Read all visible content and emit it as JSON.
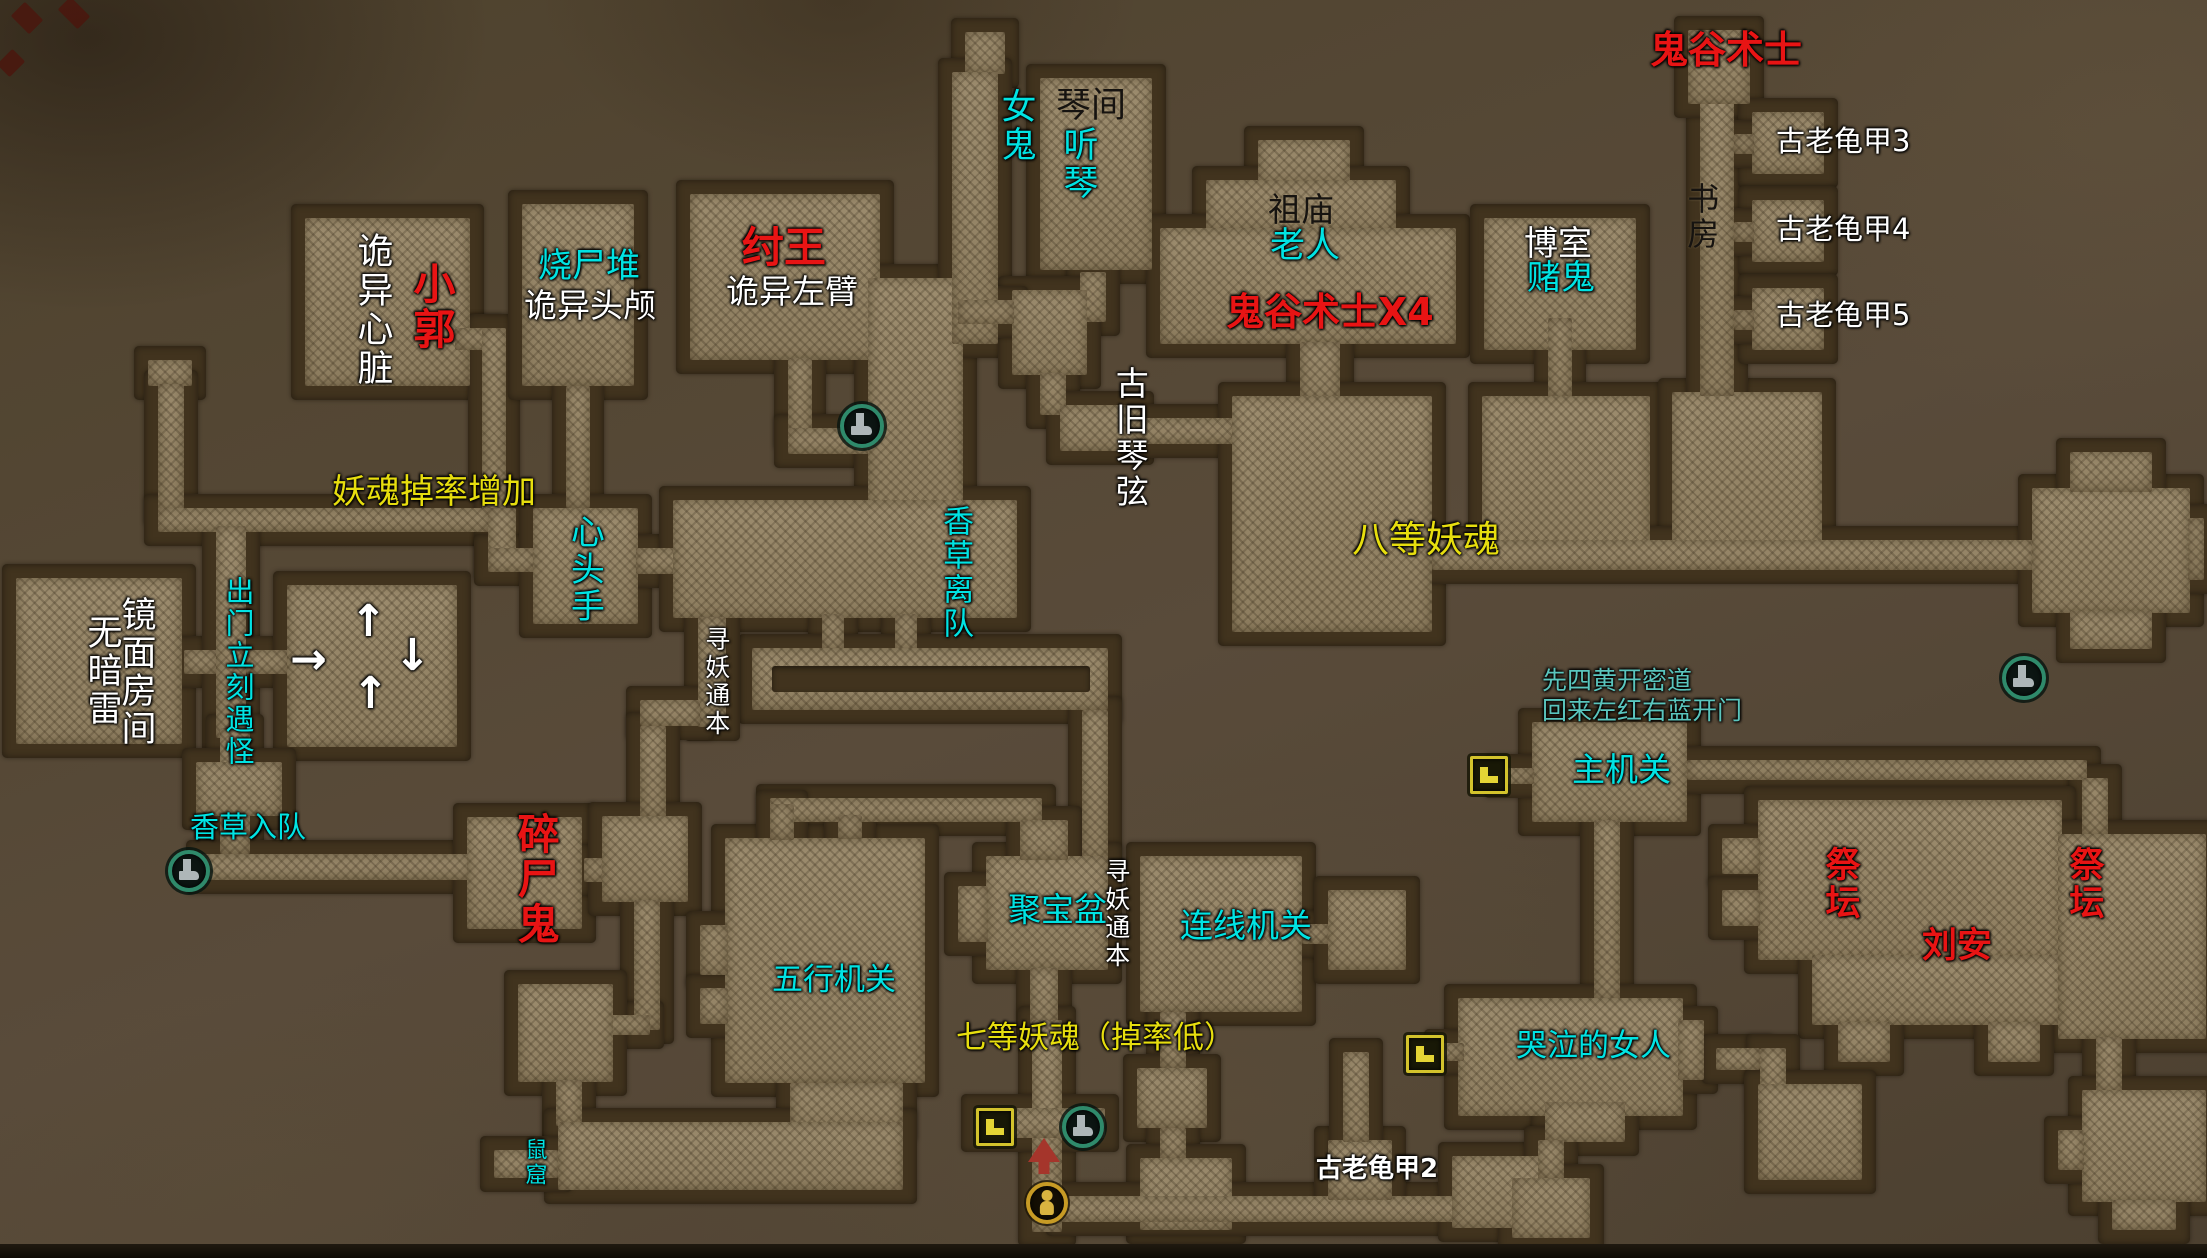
{
  "map": {
    "colors": {
      "red": "#e81414",
      "cyan": "#00e3e3",
      "yellow": "#e7de0e",
      "teal": "#5ac5bd",
      "white": "#ffffff",
      "wall": "#41331e",
      "floor": "#948466"
    },
    "labels": [
      {
        "t": "诡异心脏",
        "c": "white",
        "v": 1,
        "s": 36,
        "x": 352,
        "y": 232
      },
      {
        "t": "小郭",
        "c": "red",
        "v": 1,
        "s": 42,
        "b": 1,
        "x": 408,
        "y": 262
      },
      {
        "t": "烧尸堆",
        "c": "cyan",
        "s": 34,
        "x": 538,
        "y": 248
      },
      {
        "t": "诡异头颅",
        "c": "white",
        "s": 33,
        "x": 524,
        "y": 288
      },
      {
        "t": "纣王",
        "c": "red",
        "s": 42,
        "b": 1,
        "x": 742,
        "y": 226
      },
      {
        "t": "诡异左臂",
        "c": "white",
        "s": 33,
        "x": 726,
        "y": 274
      },
      {
        "t": "女鬼",
        "c": "cyan",
        "v": 1,
        "s": 35,
        "x": 996,
        "y": 88
      },
      {
        "t": "琴间",
        "c": "black",
        "s": 35,
        "x": 1056,
        "y": 88
      },
      {
        "t": "听琴",
        "c": "cyan",
        "v": 1,
        "s": 35,
        "x": 1058,
        "y": 126
      },
      {
        "t": "祖庙",
        "c": "black",
        "s": 33,
        "x": 1268,
        "y": 192
      },
      {
        "t": "老人",
        "c": "cyan",
        "s": 35,
        "x": 1270,
        "y": 228
      },
      {
        "t": "鬼谷术士X4",
        "c": "red",
        "s": 38,
        "b": 1,
        "x": 1226,
        "y": 292
      },
      {
        "t": "博室",
        "c": "white",
        "s": 34,
        "x": 1524,
        "y": 226
      },
      {
        "t": "赌鬼",
        "c": "cyan",
        "s": 34,
        "x": 1527,
        "y": 260
      },
      {
        "t": "鬼谷术士",
        "c": "red",
        "s": 38,
        "b": 1,
        "x": 1650,
        "y": 30
      },
      {
        "t": "书房",
        "c": "black",
        "v": 1,
        "s": 32,
        "x": 1684,
        "y": 182
      },
      {
        "t": "古老龟甲3",
        "c": "white",
        "s": 29,
        "x": 1776,
        "y": 126
      },
      {
        "t": "古老龟甲4",
        "c": "white",
        "s": 29,
        "x": 1776,
        "y": 214
      },
      {
        "t": "古老龟甲5",
        "c": "white",
        "s": 29,
        "x": 1776,
        "y": 300
      },
      {
        "t": "古旧琴弦",
        "c": "white",
        "v": 1,
        "s": 33,
        "x": 1112,
        "y": 366
      },
      {
        "t": "妖魂掉率增加",
        "c": "yellow",
        "s": 34,
        "x": 332,
        "y": 474
      },
      {
        "t": "心头手",
        "c": "cyan",
        "v": 1,
        "s": 34,
        "x": 566,
        "y": 514
      },
      {
        "t": "香草离队",
        "c": "cyan",
        "v": 1,
        "s": 31,
        "x": 938,
        "y": 505
      },
      {
        "t": "八等妖魂",
        "c": "yellow",
        "s": 37,
        "x": 1352,
        "y": 520
      },
      {
        "t": "镜面房间",
        "c": "white",
        "v": 1,
        "s": 35,
        "x": 116,
        "y": 596
      },
      {
        "t": "无暗雷",
        "c": "white",
        "v": 1,
        "s": 35,
        "x": 82,
        "y": 614
      },
      {
        "t": "出门立刻遇怪",
        "c": "cyan",
        "v": 1,
        "s": 29,
        "x": 222,
        "y": 576
      },
      {
        "t": "香草入队",
        "c": "cyan",
        "s": 29,
        "x": 190,
        "y": 812
      },
      {
        "t": "↑",
        "c": "white",
        "s": 44,
        "b": 1,
        "x": 350,
        "y": 598
      },
      {
        "t": "→",
        "c": "white",
        "s": 44,
        "b": 1,
        "x": 290,
        "y": 636
      },
      {
        "t": "↓",
        "c": "white",
        "s": 44,
        "b": 1,
        "x": 394,
        "y": 632
      },
      {
        "t": "↑",
        "c": "white",
        "s": 44,
        "b": 1,
        "x": 352,
        "y": 670
      },
      {
        "t": "寻妖通本",
        "c": "white",
        "v": 1,
        "s": 25,
        "x": 702,
        "y": 626
      },
      {
        "t": "碎尸鬼",
        "c": "red",
        "v": 1,
        "s": 42,
        "b": 1,
        "x": 512,
        "y": 812
      },
      {
        "t": "五行机关",
        "c": "cyan",
        "s": 31,
        "x": 772,
        "y": 964
      },
      {
        "t": "聚宝盆",
        "c": "cyan",
        "s": 33,
        "x": 1008,
        "y": 892
      },
      {
        "t": "寻妖通本",
        "c": "white",
        "v": 1,
        "s": 25,
        "x": 1102,
        "y": 858
      },
      {
        "t": "连线机关",
        "c": "cyan",
        "s": 33,
        "x": 1180,
        "y": 908
      },
      {
        "t": "七等妖魂（掉率低）",
        "c": "yellow",
        "s": 31,
        "x": 956,
        "y": 1022
      },
      {
        "t": "先四黄开密道",
        "c": "teal",
        "s": 25,
        "x": 1542,
        "y": 668
      },
      {
        "t": "回来左红右蓝开门",
        "c": "teal",
        "s": 25,
        "x": 1542,
        "y": 698
      },
      {
        "t": "主机关",
        "c": "cyan",
        "s": 33,
        "x": 1572,
        "y": 752
      },
      {
        "t": "祭坛",
        "c": "red",
        "v": 1,
        "s": 35,
        "b": 1,
        "x": 1820,
        "y": 846
      },
      {
        "t": "祭坛",
        "c": "red",
        "v": 1,
        "s": 35,
        "b": 1,
        "x": 2064,
        "y": 846
      },
      {
        "t": "刘安",
        "c": "red",
        "s": 35,
        "b": 1,
        "x": 1922,
        "y": 928
      },
      {
        "t": "哭泣的女人",
        "c": "cyan",
        "s": 31,
        "x": 1516,
        "y": 1030
      },
      {
        "t": "鼠窟",
        "c": "cyan",
        "v": 1,
        "s": 22,
        "x": 522,
        "y": 1138
      },
      {
        "t": "古老龟甲2",
        "c": "white",
        "s": 26,
        "b": 1,
        "x": 1316,
        "y": 1156
      }
    ],
    "icons": [
      {
        "k": "boot",
        "x": 168,
        "y": 850,
        "s": 34
      },
      {
        "k": "boot",
        "x": 840,
        "y": 404,
        "s": 36
      },
      {
        "k": "boot",
        "x": 2002,
        "y": 656,
        "s": 36
      },
      {
        "k": "boot",
        "x": 1062,
        "y": 1106,
        "s": 34
      },
      {
        "k": "stairs",
        "x": 1470,
        "y": 756,
        "s": 32
      },
      {
        "k": "stairs",
        "x": 1406,
        "y": 1035,
        "s": 32
      },
      {
        "k": "stairs",
        "x": 976,
        "y": 1108,
        "s": 32
      },
      {
        "k": "arrow",
        "x": 1026,
        "y": 1138,
        "s": 36
      },
      {
        "k": "person",
        "x": 1026,
        "y": 1182,
        "s": 34
      }
    ],
    "shapes": [
      [
        305,
        218,
        165,
        168
      ],
      [
        455,
        328,
        36,
        22
      ],
      [
        482,
        328,
        24,
        184
      ],
      [
        522,
        204,
        112,
        182
      ],
      [
        566,
        386,
        24,
        122
      ],
      [
        690,
        194,
        190,
        166
      ],
      [
        788,
        358,
        24,
        78
      ],
      [
        788,
        428,
        84,
        26
      ],
      [
        868,
        278,
        95,
        252
      ],
      [
        965,
        32,
        40,
        42
      ],
      [
        952,
        72,
        46,
        272
      ],
      [
        1040,
        78,
        112,
        192
      ],
      [
        1080,
        272,
        26,
        50
      ],
      [
        1012,
        290,
        75,
        85
      ],
      [
        958,
        300,
        56,
        24
      ],
      [
        1040,
        373,
        26,
        42
      ],
      [
        1060,
        405,
        80,
        46
      ],
      [
        1140,
        418,
        96,
        26
      ],
      [
        1258,
        140,
        92,
        45
      ],
      [
        1206,
        180,
        190,
        52
      ],
      [
        1160,
        228,
        296,
        116
      ],
      [
        1300,
        342,
        40,
        58
      ],
      [
        1232,
        396,
        200,
        236
      ],
      [
        1484,
        218,
        152,
        132
      ],
      [
        1548,
        318,
        24,
        80
      ],
      [
        1482,
        396,
        168,
        168
      ],
      [
        1672,
        392,
        150,
        170
      ],
      [
        1432,
        540,
        602,
        30
      ],
      [
        1700,
        70,
        34,
        326
      ],
      [
        1688,
        30,
        62,
        74
      ],
      [
        1752,
        112,
        72,
        62
      ],
      [
        1734,
        134,
        20,
        20
      ],
      [
        1752,
        200,
        72,
        62
      ],
      [
        1734,
        222,
        20,
        20
      ],
      [
        1752,
        288,
        72,
        62
      ],
      [
        1734,
        310,
        20,
        20
      ],
      [
        2032,
        488,
        158,
        125
      ],
      [
        2070,
        452,
        82,
        40
      ],
      [
        2070,
        611,
        82,
        38
      ],
      [
        2188,
        518,
        16,
        62
      ],
      [
        148,
        360,
        44,
        26
      ],
      [
        158,
        384,
        26,
        128
      ],
      [
        158,
        508,
        332,
        24
      ],
      [
        488,
        508,
        28,
        58
      ],
      [
        488,
        548,
        48,
        24
      ],
      [
        533,
        508,
        105,
        116
      ],
      [
        636,
        548,
        46,
        26
      ],
      [
        16,
        578,
        166,
        166
      ],
      [
        184,
        650,
        34,
        24
      ],
      [
        216,
        526,
        30,
        212
      ],
      [
        246,
        650,
        42,
        24
      ],
      [
        287,
        585,
        170,
        162
      ],
      [
        220,
        728,
        30,
        126
      ],
      [
        196,
        762,
        86,
        54
      ],
      [
        200,
        854,
        272,
        26
      ],
      [
        673,
        500,
        344,
        118
      ],
      [
        822,
        614,
        22,
        38
      ],
      [
        895,
        614,
        22,
        38
      ],
      [
        752,
        648,
        356,
        62
      ],
      [
        698,
        617,
        28,
        110
      ],
      [
        640,
        700,
        60,
        26
      ],
      [
        640,
        726,
        26,
        92
      ],
      [
        1082,
        710,
        26,
        150
      ],
      [
        770,
        798,
        272,
        24
      ],
      [
        467,
        817,
        115,
        112
      ],
      [
        584,
        858,
        22,
        24
      ],
      [
        602,
        816,
        86,
        86
      ],
      [
        634,
        900,
        26,
        130
      ],
      [
        600,
        1015,
        50,
        20
      ],
      [
        518,
        984,
        95,
        98
      ],
      [
        556,
        1080,
        26,
        46
      ],
      [
        725,
        838,
        200,
        245
      ],
      [
        700,
        925,
        28,
        50
      ],
      [
        700,
        988,
        28,
        36
      ],
      [
        770,
        804,
        24,
        36
      ],
      [
        838,
        815,
        24,
        24
      ],
      [
        790,
        1083,
        113,
        45
      ],
      [
        558,
        1122,
        345,
        68
      ],
      [
        494,
        1150,
        64,
        28
      ],
      [
        986,
        856,
        122,
        114
      ],
      [
        1020,
        820,
        48,
        40
      ],
      [
        958,
        886,
        30,
        56
      ],
      [
        1030,
        968,
        28,
        56
      ],
      [
        1032,
        1020,
        30,
        212
      ],
      [
        975,
        1108,
        130,
        30
      ],
      [
        1140,
        856,
        162,
        156
      ],
      [
        1302,
        924,
        28,
        20
      ],
      [
        1328,
        890,
        78,
        80
      ],
      [
        1160,
        1012,
        26,
        56
      ],
      [
        1137,
        1068,
        70,
        60
      ],
      [
        1160,
        1128,
        26,
        32
      ],
      [
        1140,
        1158,
        92,
        72
      ],
      [
        1060,
        1196,
        420,
        26
      ],
      [
        1328,
        1140,
        64,
        60
      ],
      [
        1343,
        1052,
        26,
        90
      ],
      [
        1452,
        1156,
        92,
        72
      ],
      [
        1532,
        722,
        155,
        100
      ],
      [
        1498,
        768,
        36,
        16
      ],
      [
        1687,
        760,
        400,
        20
      ],
      [
        2082,
        778,
        26,
        58
      ],
      [
        1594,
        820,
        26,
        180
      ],
      [
        1758,
        800,
        304,
        160
      ],
      [
        1812,
        955,
        250,
        70
      ],
      [
        2058,
        834,
        148,
        205
      ],
      [
        1722,
        838,
        38,
        36
      ],
      [
        1722,
        890,
        38,
        36
      ],
      [
        1838,
        1022,
        52,
        40
      ],
      [
        1988,
        1022,
        52,
        40
      ],
      [
        2096,
        1037,
        26,
        56
      ],
      [
        2082,
        1090,
        124,
        112
      ],
      [
        2112,
        1200,
        64,
        30
      ],
      [
        2058,
        1130,
        26,
        40
      ],
      [
        1458,
        998,
        225,
        118
      ],
      [
        1545,
        1102,
        80,
        40
      ],
      [
        1538,
        1140,
        26,
        40
      ],
      [
        1512,
        1178,
        78,
        60
      ],
      [
        1678,
        1020,
        26,
        60
      ],
      [
        1438,
        1043,
        26,
        18
      ],
      [
        1716,
        1048,
        44,
        22
      ],
      [
        1760,
        1048,
        26,
        50
      ],
      [
        1758,
        1084,
        104,
        96
      ]
    ],
    "notches": [
      [
        772,
        666,
        318,
        26
      ]
    ],
    "decor": [
      [
        14,
        8,
        26,
        20
      ],
      [
        60,
        4,
        28,
        18
      ],
      [
        2,
        52,
        18,
        22
      ]
    ]
  }
}
